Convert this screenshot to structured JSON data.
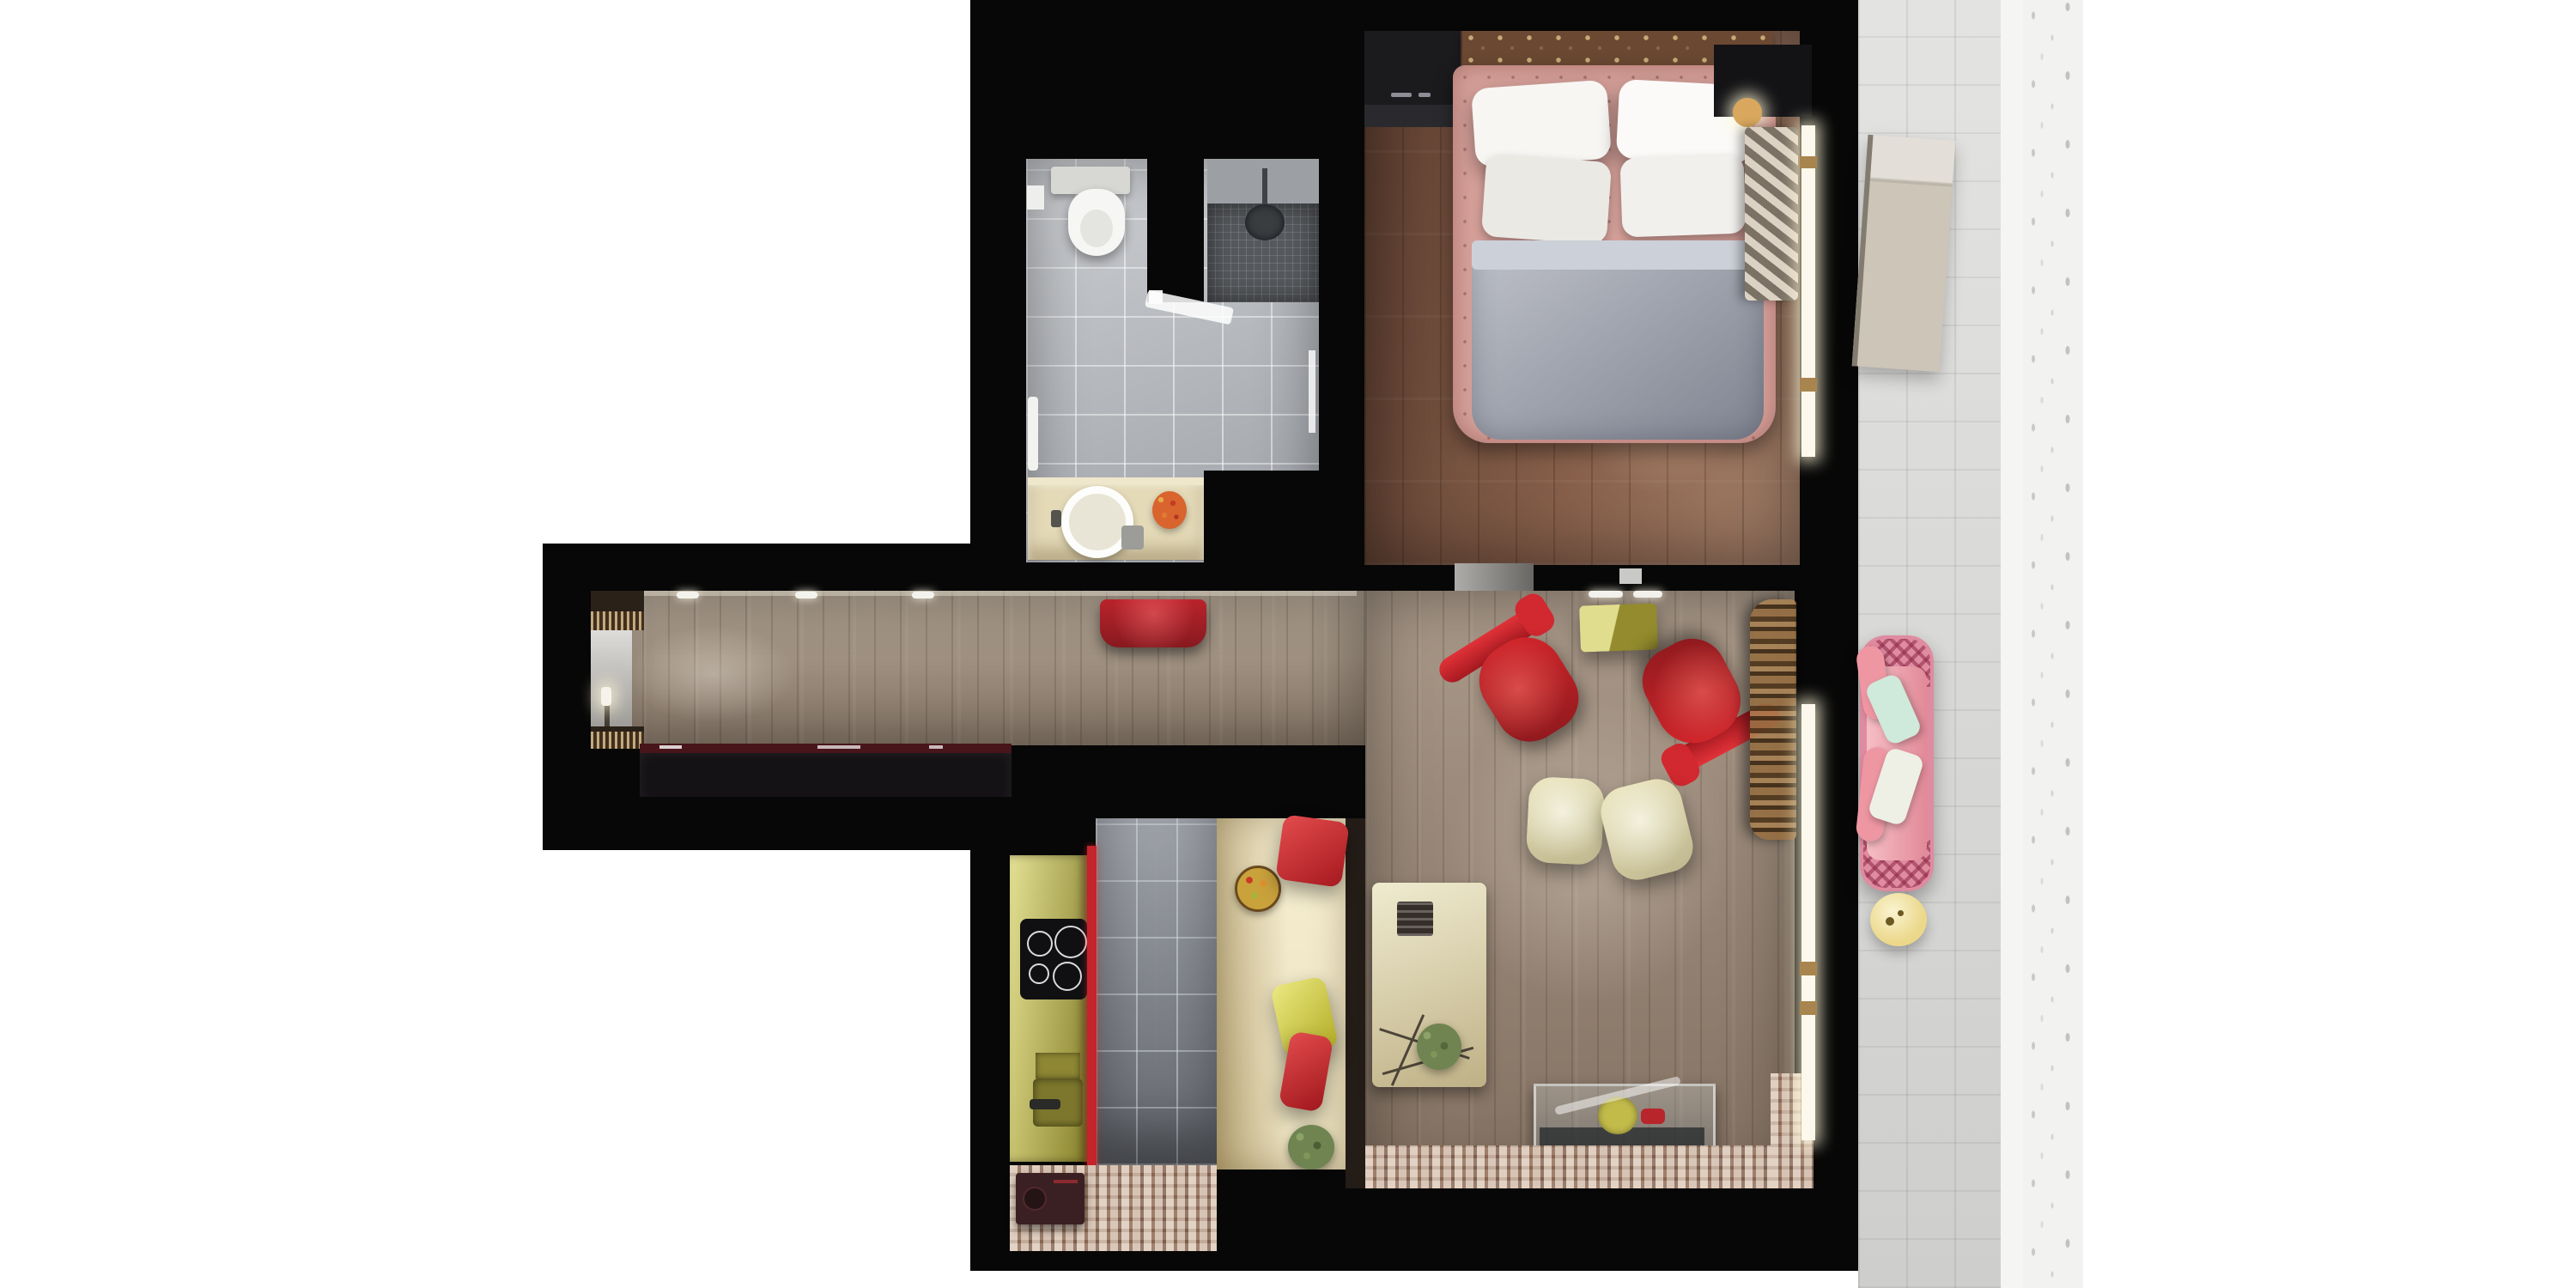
{
  "scene": {
    "type": "apartment-floor-plan-3d-top-view",
    "rooms": [
      {
        "name": "bathroom",
        "items": [
          "toilet",
          "cistern",
          "shower",
          "shower-head",
          "glass-door",
          "vanity-counter",
          "round-sink",
          "faucet",
          "flowers",
          "towel"
        ]
      },
      {
        "name": "bedroom",
        "items": [
          "double-bed",
          "headboard",
          "pillows",
          "duvet",
          "wardrobe",
          "nightstand",
          "bedside-lamp",
          "curtain",
          "window",
          "door-opening"
        ]
      },
      {
        "name": "hallway",
        "items": [
          "sideboard",
          "console-shelf",
          "mirror",
          "candle",
          "red-bench",
          "ceiling-spotlights"
        ]
      },
      {
        "name": "living-room",
        "items": [
          "red-armchair-left",
          "red-armchair-right",
          "cream-pouf",
          "cream-pouf",
          "olive-side-table",
          "rattan-screen",
          "glass-display-table",
          "dining-table",
          "serving-tray",
          "plant",
          "window",
          "mosaic-floor-strip"
        ]
      },
      {
        "name": "kitchen",
        "items": [
          "olive-counter",
          "induction-cooktop",
          "sink",
          "wall-recess",
          "red-glass-panel",
          "vintage-stove",
          "mosaic-floor"
        ]
      },
      {
        "name": "dining-nook",
        "items": [
          "banquette",
          "fruit-bowl",
          "red-pillow",
          "yellow-pillow",
          "red-pillow",
          "plant"
        ]
      },
      {
        "name": "balcony",
        "items": [
          "sun-lounger",
          "pink-wicker-sofa",
          "bolster-pillows",
          "mint-pillow",
          "white-pillow",
          "round-side-table"
        ]
      }
    ]
  },
  "colors": {
    "page_bg": "#ffffff",
    "wall": "#070707",
    "balcony_tile": "#dadad8",
    "balcony_edge": "#f5f5f4",
    "facade": "#f2f2f1",
    "bath_tile": "#b9bcc1",
    "shower_wall": "#9ca0a4",
    "shower_mosaic": "#55585c",
    "shower_head": "#3a3d40",
    "toilet_white": "#f6f6f4",
    "cistern_gray": "#d7d7d4",
    "vanity_cream": "#e4dab8",
    "sink_white": "#fbfbf8",
    "flowers_orange": "#d9642e",
    "soap_gray": "#9c9c98",
    "bedroom_wood": "#7d5a47",
    "wardrobe_dark": "#1b1b1e",
    "headboard_brown": "#6a4832",
    "bed_frame_pink": "#d6a19a",
    "pillow_white": "#f7f6f3",
    "duvet_gray": "#9da1ad",
    "duvet_fold": "#ccd0d8",
    "nightstand_dark": "#131316",
    "lamp_gold": "#d9a85e",
    "curtain_beige": "#b3a797",
    "window_glow": "#fdf8ec",
    "window_frame_gold": "#a8854e",
    "door_gap_gray": "#8b8985",
    "hall_wood": "#a39483",
    "living_wood": "#9c8a79",
    "sideboard_dark": "#141215",
    "sideboard_top_maroon": "#47151a",
    "console_dark": "#2a2118",
    "mirror_silver": "#b5b2ad",
    "candle_white": "#f6f4ea",
    "bench_red": "#cf2730",
    "chair_red": "#d5262c",
    "pouf_cream": "#eae3ba",
    "olive_table": "#c2bb4a",
    "glass_tint": "#c3ced0",
    "glass_shelf_dark": "#23282b",
    "dining_cream": "#ddd2a8",
    "tray_dark": "#352e29",
    "plant_green": "#6f8451",
    "kitchen_tile": "#8e929a",
    "counter_olive": "#c5bf52",
    "sink_olive": "#7c772c",
    "cooktop_black": "#101012",
    "red_panel": "#c4242b",
    "stove_maroon": "#3a2022",
    "mosaic_base": "#ad9281",
    "nook_cream": "#e9dcb4",
    "pillow_red": "#cf2730",
    "pillow_yellow": "#d8d23a",
    "fruit_bowl_gold": "#caa23c",
    "sofa_frame_pink": "#df8ba0",
    "sofa_cushion_pink": "#f2a2ac",
    "pillow_mint": "#cfe9da",
    "pillow_offwhite": "#eef0e6",
    "side_table_yellow": "#ecd88a",
    "lounger_beige": "#ccc5b8",
    "spotlight_white": "#f4f2ec"
  }
}
